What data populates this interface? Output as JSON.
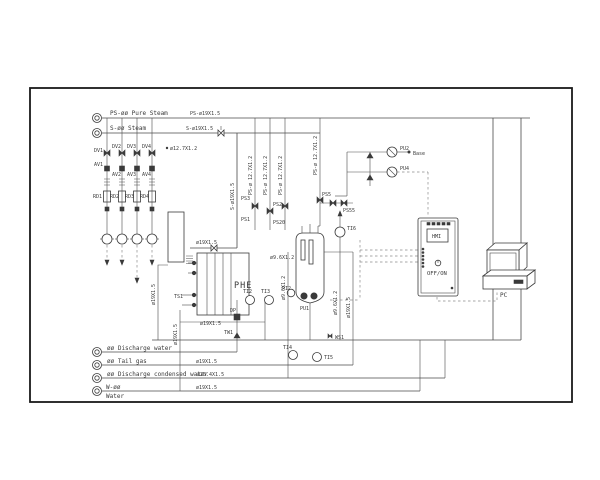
{
  "diagram": {
    "top_lines": {
      "pure_steam_label": "PS-øø Pure Steam",
      "pure_steam_spec": "PS-ø19X1.5",
      "steam_label": "S-øø Steam",
      "steam_spec": "S-ø19X1.5"
    },
    "pipe_specs": {
      "d127": "ø12.7X1.2",
      "ps127": "PS-ø 12.7X1.2",
      "s19": "S-ø19X1.5",
      "d19": "ø19X1.5",
      "d96": "ø9.6X1.2",
      "d254": "ø25.4X1.5"
    },
    "branches": [
      {
        "valve": "DV1",
        "vent": "AV1",
        "meter": "RD1"
      },
      {
        "valve": "DV2",
        "vent": "AV2",
        "meter": "RD2"
      },
      {
        "valve": "DV3",
        "vent": "AV3",
        "meter": "RD3"
      },
      {
        "valve": "DV4",
        "vent": "AV4",
        "meter": "RD4"
      }
    ],
    "instruments": {
      "ps1": "PS1",
      "ps2": "PS2",
      "ps20": "PS20",
      "ps3": "PS3",
      "ps5": "PS5",
      "ps55": "PS55",
      "ti2": "TI2",
      "ti3": "TI3",
      "ti4": "TI4",
      "ti5": "TI5",
      "ti6": "TI6",
      "ts1": "TS1",
      "tw1": "TW1",
      "ws1": "WS1",
      "dp": "DP",
      "pi2": "PI2"
    },
    "pumps": {
      "pu1": "PU1",
      "pu2": "PU2",
      "pu4": "PU4",
      "dose_target": "Base"
    },
    "equipment": {
      "phe": "PHE",
      "hmi": "HMI",
      "hmi_power": "OFF/ON",
      "pc": "PC"
    },
    "bottom_lines": {
      "discharge_water": "øø Discharge water",
      "tail_gas": "øø Tail gas",
      "condensed": "øø Discharge condensed water",
      "water_tag": "W-øø",
      "water_name": "Water"
    }
  }
}
